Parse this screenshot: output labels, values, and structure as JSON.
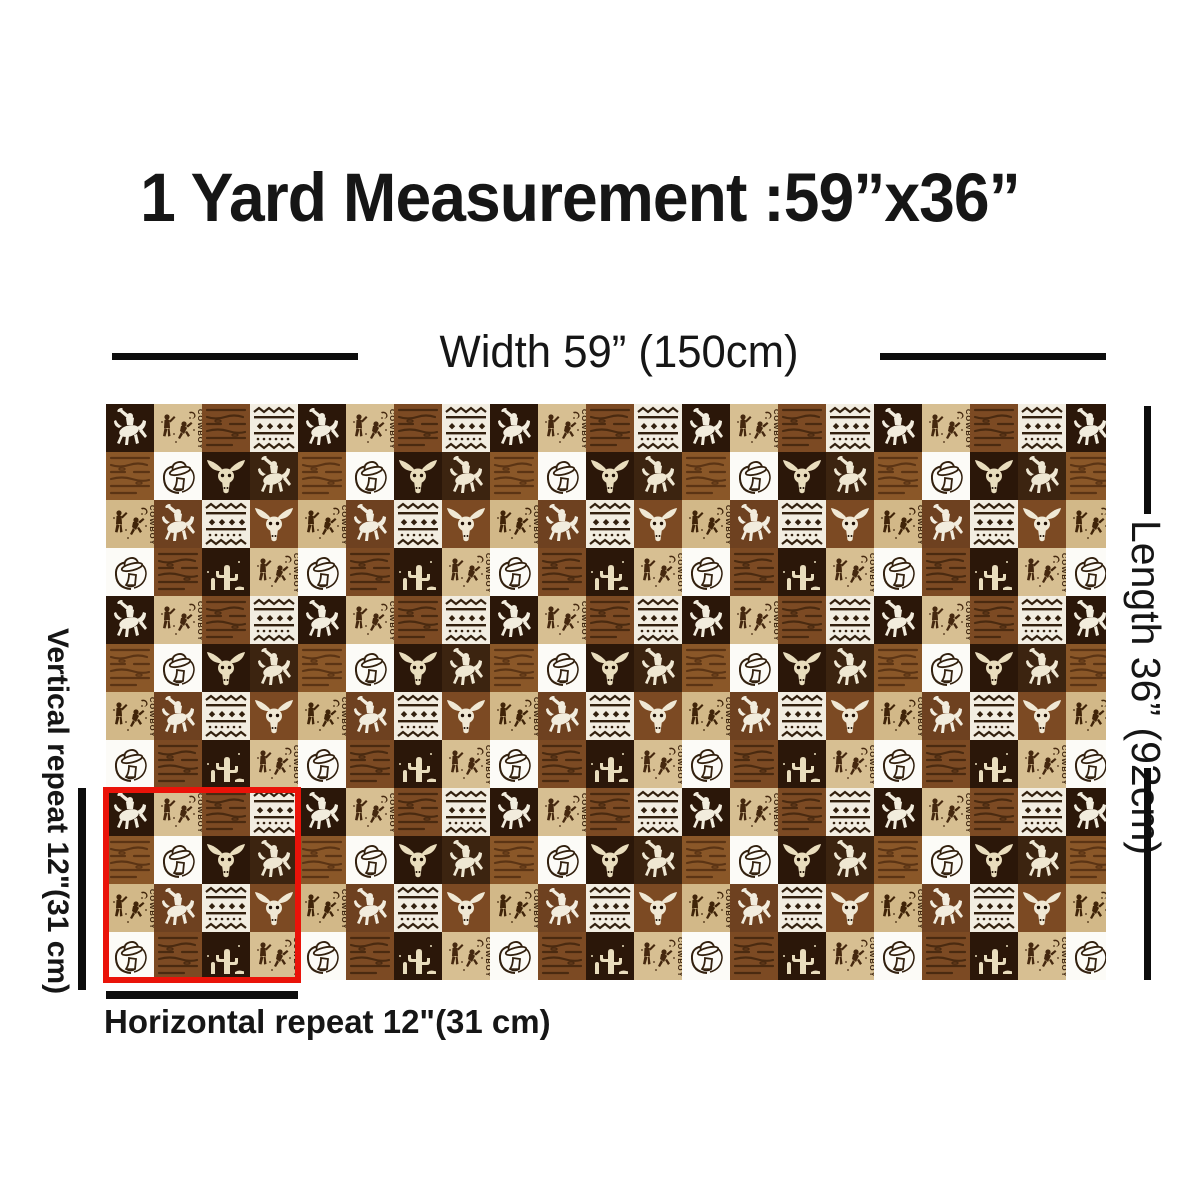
{
  "title": "1 Yard Measurement :59”x36”",
  "dimension_labels": {
    "width": "Width 59”  (150cm)",
    "length": "Length 36”  (92cm)",
    "vertical_repeat": "Vertical repeat 12\"(31 cm)",
    "horizontal_repeat": "Horizontal repeat 12\"(31 cm)"
  },
  "fabric": {
    "cowboy_text": "COWBOY",
    "motifs": [
      "bucking-bronco-rider",
      "longhorn-bull-skull",
      "cowboy-hat-and-boot",
      "wood-grain-planks",
      "aztec-stripe-band",
      "cowboy-figures-sketch",
      "cactus"
    ],
    "palette": {
      "dark_brown": "#2b1709",
      "brown": "#7c4a23",
      "light_brown": "#8a5728",
      "tan": "#d7bf92",
      "cream": "#f2ede1",
      "white": "#fcfbf7",
      "sketch_ink": "#45280f",
      "silhouette_cream": "#f2ecdd"
    },
    "repeat_outline_color": "#ea1309",
    "annotation_line_color": "#0d0d0d"
  }
}
